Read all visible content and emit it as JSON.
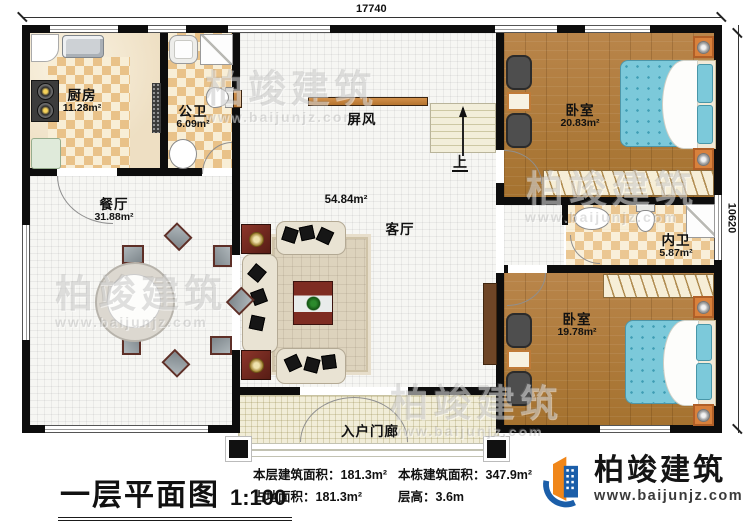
{
  "dimensions": {
    "width_top": "17740",
    "height_right": "10620"
  },
  "rooms": {
    "kitchen": {
      "name": "厨房",
      "area": "11.28m²"
    },
    "public_bath": {
      "name": "公卫",
      "area": "6.09m²"
    },
    "dining": {
      "name": "餐厅",
      "area": "31.88m²"
    },
    "living": {
      "name": "客厅",
      "area": "54.84m²"
    },
    "screen": {
      "name": "屏风"
    },
    "bedroom_top": {
      "name": "卧室",
      "area": "20.83m²"
    },
    "inner_bath": {
      "name": "内卫",
      "area": "5.87m²"
    },
    "bedroom_bottom": {
      "name": "卧室",
      "area": "19.78m²"
    },
    "porch": {
      "name": "入户门廊"
    },
    "stairs": {
      "up_label": "上"
    }
  },
  "footer": {
    "title": "一层平面图",
    "scale": "1:100",
    "stats": [
      {
        "label": "本层建筑面积：",
        "value": "181.3m²"
      },
      {
        "label": "占地面积：",
        "value": "181.3m²"
      },
      {
        "label": "本栋建筑面积：",
        "value": "347.9m²"
      },
      {
        "label": "层高：",
        "value": "3.6m"
      }
    ]
  },
  "logo": {
    "name": "柏竣建筑",
    "url": "www.baijunjz.com"
  },
  "watermark": {
    "text": "柏竣建筑",
    "url": "www.baijunjz.com"
  },
  "colors": {
    "wall": "#0d0d0d",
    "wood": "#b5813f",
    "bed_blue": "#7cc9da",
    "brand_blue": "#1b5ea9",
    "brand_orange": "#f08619"
  }
}
